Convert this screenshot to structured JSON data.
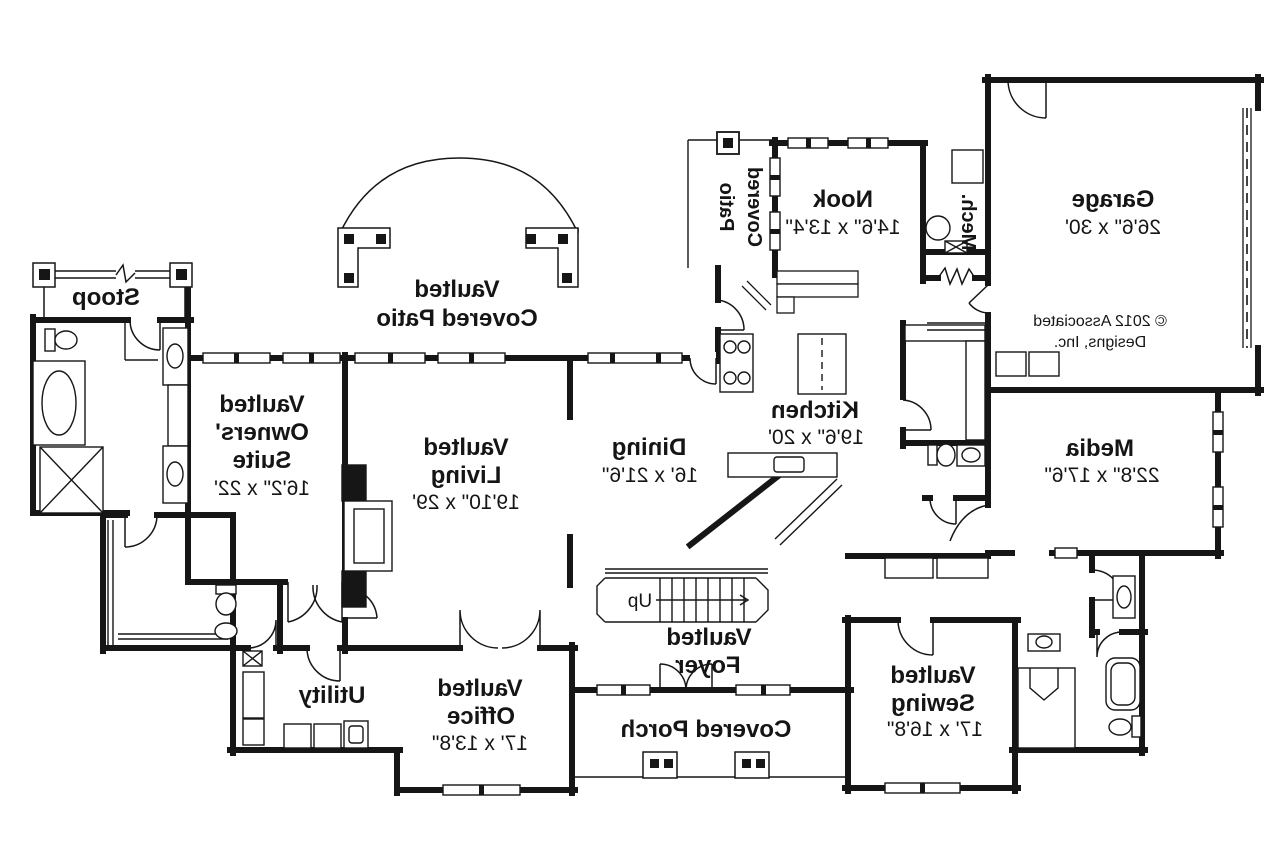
{
  "meta": {
    "background": "#ffffff",
    "ink": "#161616",
    "note": "mirrored architectural first-floor plan"
  },
  "labels": {
    "stoop": {
      "name": "Stoop"
    },
    "patio_side": {
      "line1": "Covered",
      "line2": "Patio"
    },
    "vaulted_patio": {
      "line1": "Vaulted",
      "line2": "Covered Patio"
    },
    "nook": {
      "name": "Nook",
      "dims": "14'6\" x 13'4\""
    },
    "mech": {
      "name": "Mech."
    },
    "garage": {
      "name": "Garage",
      "dims": "26'6\" x 30'"
    },
    "copyright": {
      "line1": "© 2012 Associated",
      "line2": "Designs, Inc."
    },
    "owners_suite": {
      "line1": "Vaulted",
      "line2": "Owners'",
      "line3": "Suite",
      "dims": "16'2\" x 22'"
    },
    "living": {
      "line1": "Vaulted",
      "line2": "Living",
      "dims": "19'10\" x 29'"
    },
    "dining": {
      "name": "Dining",
      "dims": "16' x 21'6\""
    },
    "kitchen": {
      "name": "Kitchen",
      "dims": "19'6\" x 20'"
    },
    "media": {
      "name": "Media",
      "dims": "22'8\" x 17'6\""
    },
    "stairs": {
      "up": "Up"
    },
    "foyer": {
      "line1": "Vaulted",
      "line2": "Foyer"
    },
    "utility": {
      "name": "Utility"
    },
    "office": {
      "line1": "Vaulted",
      "line2": "Office",
      "dims": "17' x 13'8\""
    },
    "porch": {
      "name": "Covered Porch"
    },
    "sewing": {
      "line1": "Vaulted",
      "line2": "Sewing",
      "dims": "17' x 16'8\""
    }
  }
}
